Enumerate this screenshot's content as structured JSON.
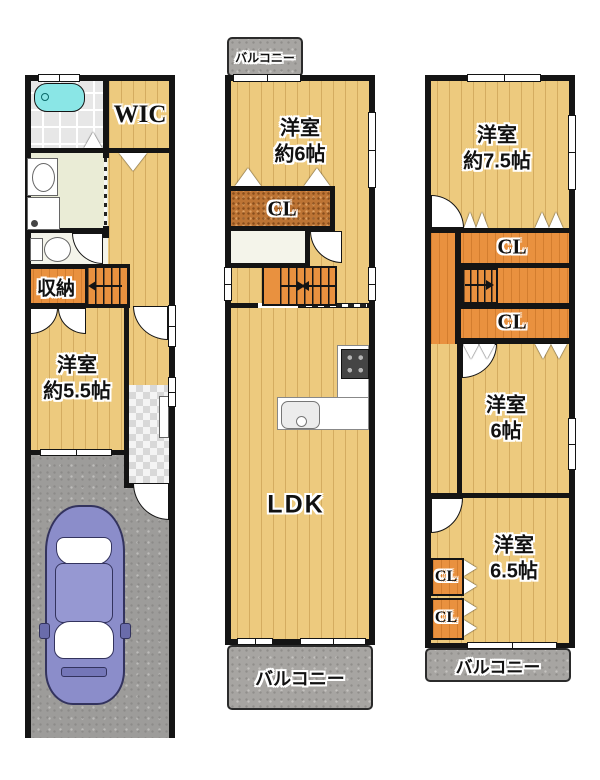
{
  "document_type": "floor-plan",
  "colors": {
    "wall": "#141414",
    "wood_floor": "#edca7e",
    "closet_orange": "#e9913f",
    "closet_brown": "#bd7434",
    "balcony_gray": "#a7a5a2",
    "parking_gray": "#9d9c9a",
    "bathtub_cyan": "#8ae6e6",
    "washroom_green": "#eaecd6",
    "car_purple": "#8b8dca"
  },
  "floor1": {
    "wic": "WIC",
    "storage": "収納",
    "room": {
      "name": "洋室",
      "size": "約5.5帖"
    }
  },
  "floor2": {
    "balcony_top": "バルコニー",
    "room": {
      "name": "洋室",
      "size": "約6帖"
    },
    "closet": "CL",
    "ldk": "LDK",
    "balcony_bottom": "バルコニー"
  },
  "floor3": {
    "room1": {
      "name": "洋室",
      "size": "約7.5帖"
    },
    "closet1": "CL",
    "closet2": "CL",
    "room2": {
      "name": "洋室",
      "size": "6帖"
    },
    "closet3": "CL",
    "closet4": "CL",
    "room3": {
      "name": "洋室",
      "size": "6.5帖"
    },
    "balcony": "バルコニー"
  }
}
